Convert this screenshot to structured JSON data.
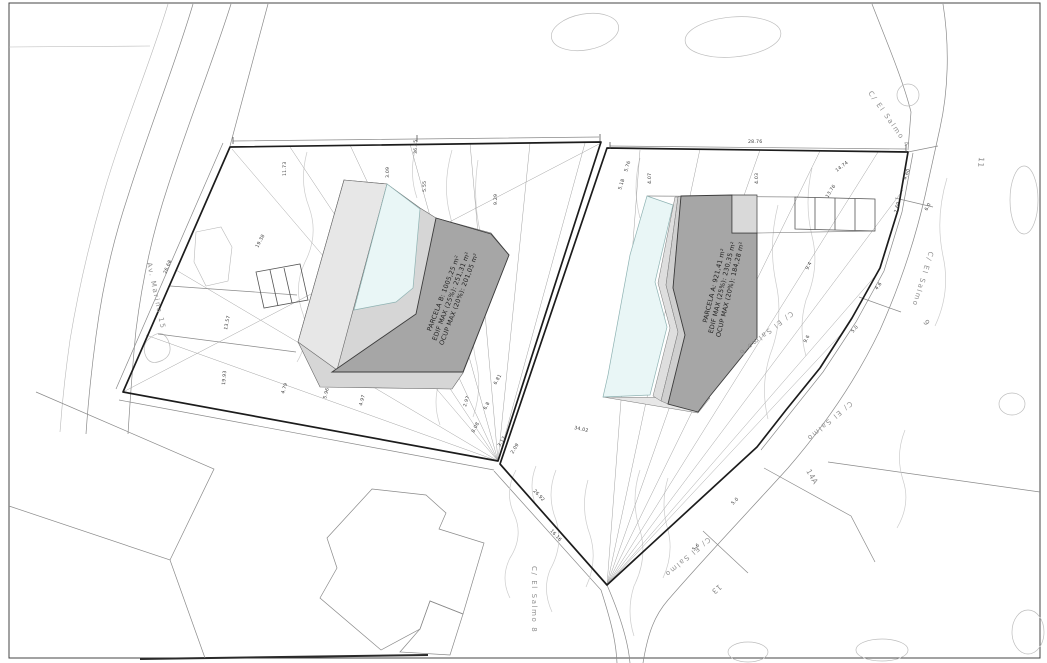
{
  "parcels": {
    "b": {
      "cx": 453,
      "cy": 297,
      "rot": -69,
      "lines": [
        "PARCELA B: 1005,25 m²",
        "EDIF MAX (25%): 251,31 m²",
        "OCUP MAX (20%): 201,05 m²"
      ]
    },
    "a": {
      "cx": 724,
      "cy": 288,
      "rot": -76,
      "lines": [
        "PARCELA A: 921,41 m²",
        "EDIF MAX (25%): 230,35 m²",
        "OCUP MAX (20%): 184,28 m²"
      ]
    }
  },
  "street_labels": [
    {
      "t": "C/ El Salmo 4",
      "x": 868,
      "y": 93,
      "r": 55,
      "s": 7.2
    },
    {
      "t": "Av. Marina 15",
      "x": 147,
      "y": 263,
      "r": 78,
      "s": 7.2
    },
    {
      "t": "C/ El Salmo 8",
      "x": 532,
      "y": 566,
      "r": 90,
      "s": 7
    },
    {
      "t": "C/ El Salmo",
      "x": 929,
      "y": 251,
      "r": 107,
      "s": 6.8
    },
    {
      "t": "C/ El Salmo 6",
      "x": 791,
      "y": 311,
      "r": 142,
      "s": 6.8
    },
    {
      "t": "C/ El Salmo",
      "x": 850,
      "y": 401,
      "r": 140,
      "s": 6.8
    },
    {
      "t": "C/ El Salmo",
      "x": 708,
      "y": 537,
      "r": 140,
      "s": 6.8
    }
  ],
  "lot_numbers": [
    {
      "t": "11",
      "x": 979,
      "y": 157,
      "r": 95
    },
    {
      "t": "9",
      "x": 923,
      "y": 322,
      "r": 55
    },
    {
      "t": "14A",
      "x": 806,
      "y": 471,
      "r": 60
    },
    {
      "t": "13",
      "x": 719,
      "y": 584,
      "r": 140
    }
  ],
  "dimensions": [
    {
      "t": "36.45",
      "x": 417,
      "y": 154,
      "r": -90
    },
    {
      "t": "3.09",
      "x": 389,
      "y": 178,
      "r": -90
    },
    {
      "t": "5.55",
      "x": 426,
      "y": 192,
      "r": -90
    },
    {
      "t": "9.29",
      "x": 497,
      "y": 205,
      "r": -90
    },
    {
      "t": "11.73",
      "x": 286,
      "y": 176,
      "r": -90
    },
    {
      "t": "26.68",
      "x": 166,
      "y": 274,
      "r": -67
    },
    {
      "t": "19.38",
      "x": 258,
      "y": 248,
      "r": -62
    },
    {
      "t": "13.57",
      "x": 227,
      "y": 330,
      "r": -78
    },
    {
      "t": "19.93",
      "x": 225,
      "y": 385,
      "r": -85
    },
    {
      "t": "4.79",
      "x": 284,
      "y": 394,
      "r": -72
    },
    {
      "t": "5.96",
      "x": 326,
      "y": 399,
      "r": -75
    },
    {
      "t": "4.97",
      "x": 362,
      "y": 406,
      "r": -75
    },
    {
      "t": "2.97",
      "x": 466,
      "y": 407,
      "r": -72
    },
    {
      "t": "6.81",
      "x": 496,
      "y": 385,
      "r": -60
    },
    {
      "t": "6.8",
      "x": 486,
      "y": 410,
      "r": -63
    },
    {
      "t": "3.17",
      "x": 500,
      "y": 447,
      "r": -58
    },
    {
      "t": "2.09",
      "x": 513,
      "y": 454,
      "r": -58
    },
    {
      "t": "8.08",
      "x": 474,
      "y": 433,
      "r": -62
    },
    {
      "t": "26.92",
      "x": 533,
      "y": 491,
      "r": 47
    },
    {
      "t": "34.02",
      "x": 574,
      "y": 429,
      "r": 12
    },
    {
      "t": "16.16",
      "x": 550,
      "y": 531,
      "r": 47
    },
    {
      "t": "28.76",
      "x": 748,
      "y": 143,
      "r": 0
    },
    {
      "t": "4.07",
      "x": 651,
      "y": 184,
      "r": -90
    },
    {
      "t": "4.03",
      "x": 758,
      "y": 184,
      "r": -90
    },
    {
      "t": "14.74",
      "x": 837,
      "y": 172,
      "r": -38
    },
    {
      "t": "13.76",
      "x": 828,
      "y": 198,
      "r": -58
    },
    {
      "t": "5.76",
      "x": 627,
      "y": 172,
      "r": -72
    },
    {
      "t": "5.18",
      "x": 621,
      "y": 190,
      "r": -72
    },
    {
      "t": "4.60",
      "x": 906,
      "y": 180,
      "r": -70
    },
    {
      "t": "2.69",
      "x": 897,
      "y": 213,
      "r": -75
    },
    {
      "t": "6.0",
      "x": 927,
      "y": 211,
      "r": -60
    },
    {
      "t": "9.4",
      "x": 808,
      "y": 270,
      "r": -62
    },
    {
      "t": "9.6",
      "x": 806,
      "y": 343,
      "r": -62
    },
    {
      "t": "4.6",
      "x": 877,
      "y": 290,
      "r": -52
    },
    {
      "t": "5.0",
      "x": 853,
      "y": 333,
      "r": -48
    },
    {
      "t": "5.0",
      "x": 733,
      "y": 505,
      "r": -45
    },
    {
      "t": "5.6",
      "x": 694,
      "y": 551,
      "r": -45
    }
  ],
  "colors": {
    "pool": "#e9f6f6",
    "building": "#a6a6a6",
    "terrace_light": "#e7e7e7",
    "terrace_mid": "#d6d6d6",
    "band_light": "#dedede",
    "band_mid": "#cfcfcf",
    "boundary": "#1c1c1c",
    "thin_line": "#8a8a8a",
    "contour": "#cccccc",
    "dim_text": "#3c3c3c",
    "street_text": "#8f8f8f",
    "lot_text": "#8a8a8a",
    "parcel_text": "#1f1f1f"
  }
}
